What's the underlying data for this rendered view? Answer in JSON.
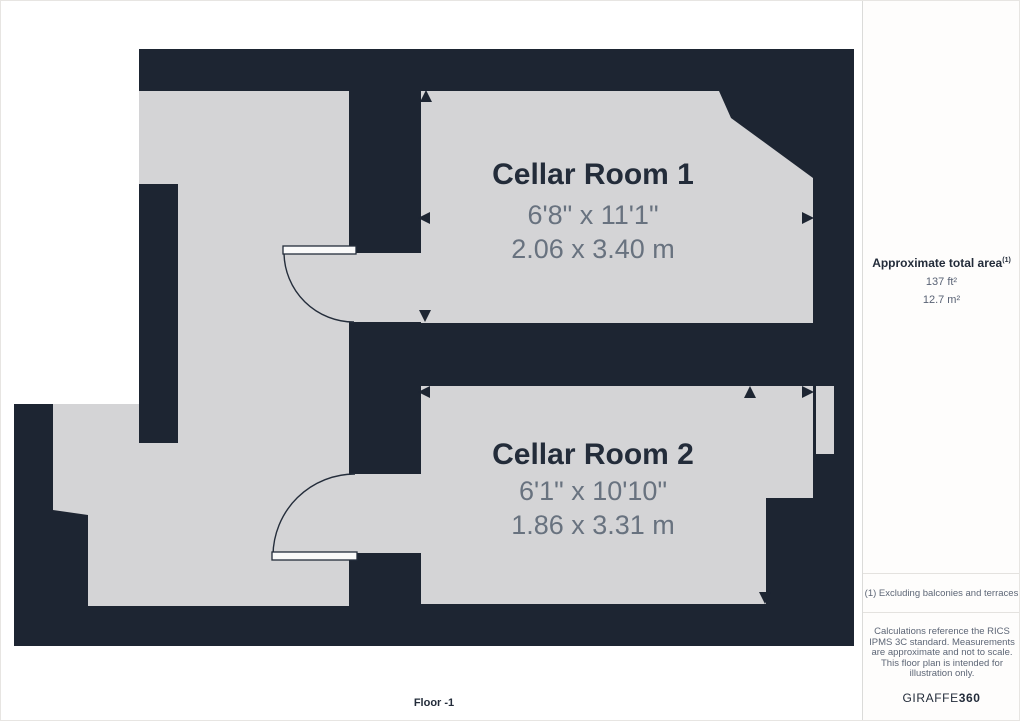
{
  "palette": {
    "wall": "#1d2532",
    "floor": "#d4d4d6",
    "page": "#ffffff",
    "title_text": "#232c3a",
    "dim_text": "#68727f",
    "muted_text": "#5d6676",
    "border": "#e4e2df"
  },
  "floor_label": "Floor -1",
  "rooms": [
    {
      "name": "Cellar Room 1",
      "imperial": "6'8\" x 11'1\"",
      "metric": "2.06 x 3.40 m"
    },
    {
      "name": "Cellar Room 2",
      "imperial": "6'1\" x 10'10\"",
      "metric": "1.86 x 3.31 m"
    }
  ],
  "sidebar": {
    "area_heading": "Approximate total area",
    "area_heading_sup": "(1)",
    "area_ft": "137 ft²",
    "area_m": "12.7 m²",
    "footnote": "(1) Excluding balconies and terraces",
    "disclaimer": "Calculations reference the RICS IPMS 3C standard. Measurements are approximate and not to scale. This floor plan is intended for illustration only.",
    "brand_name": "GIRAFFE",
    "brand_number": "360"
  }
}
